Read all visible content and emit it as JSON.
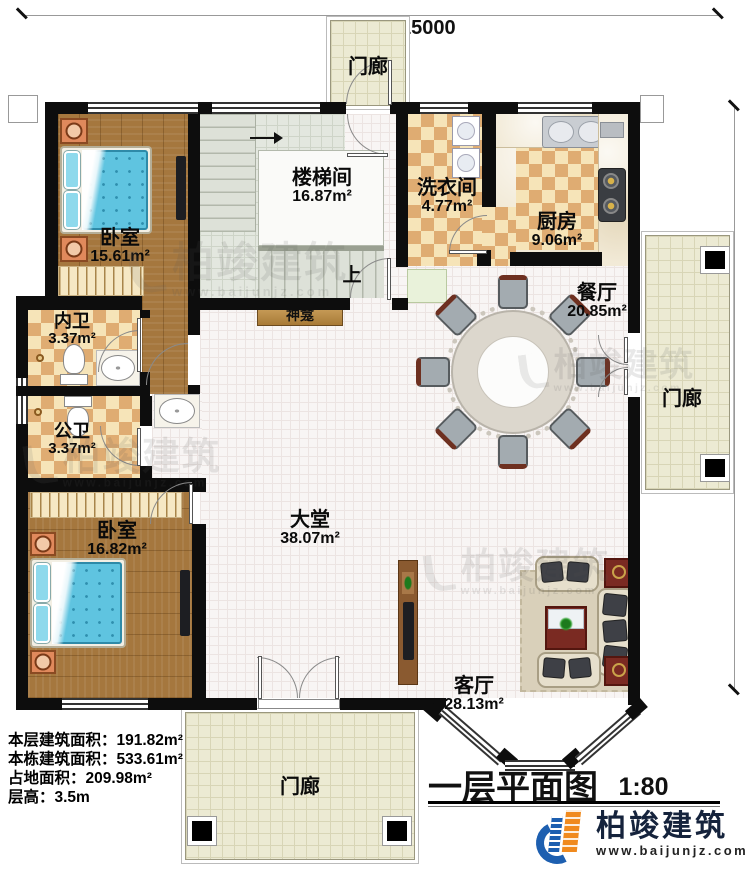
{
  "title": {
    "text": "一层平面图",
    "scale": "1:80"
  },
  "dimensions": {
    "width": "15000",
    "height": "15600"
  },
  "info_lines": {
    "l1": "本层建筑面积：191.82m²",
    "l2": "本栋建筑面积：533.61m²",
    "l3": "占地面积：209.98m²",
    "l4": "层高：3.5m"
  },
  "rooms": {
    "bedroom1": {
      "name": "卧室",
      "area": "15.61m²"
    },
    "stairwell": {
      "name": "楼梯间",
      "area": "16.87m²"
    },
    "laundry": {
      "name": "洗衣间",
      "area": "4.77m²"
    },
    "kitchen": {
      "name": "厨房",
      "area": "9.06m²"
    },
    "dining": {
      "name": "餐厅",
      "area": "20.85m²"
    },
    "bath_inner": {
      "name": "内卫",
      "area": "3.37m²"
    },
    "bath_public": {
      "name": "公卫",
      "area": "3.37m²"
    },
    "bedroom2": {
      "name": "卧室",
      "area": "16.82m²"
    },
    "hall": {
      "name": "大堂",
      "area": "38.07m²"
    },
    "living": {
      "name": "客厅",
      "area": "28.13m²"
    }
  },
  "annotations": {
    "porch": "门廊",
    "shrine": "神龛",
    "stairs_up": "上"
  },
  "brand": {
    "name": "柏竣建筑",
    "url": "www.baijunjz.com"
  },
  "watermark": {
    "name": "柏竣建筑",
    "url": "www.baijunjz.com"
  },
  "colors": {
    "wall": "#0d0d0d",
    "wood": "#a5773e",
    "tile_light": "#f6e4b8",
    "tile_dark": "#dfac72",
    "porch_tile": "#ecead3",
    "bed": "#5fc4e0",
    "accent_blue": "#1d5fb0",
    "accent_orange": "#f08a1e"
  }
}
